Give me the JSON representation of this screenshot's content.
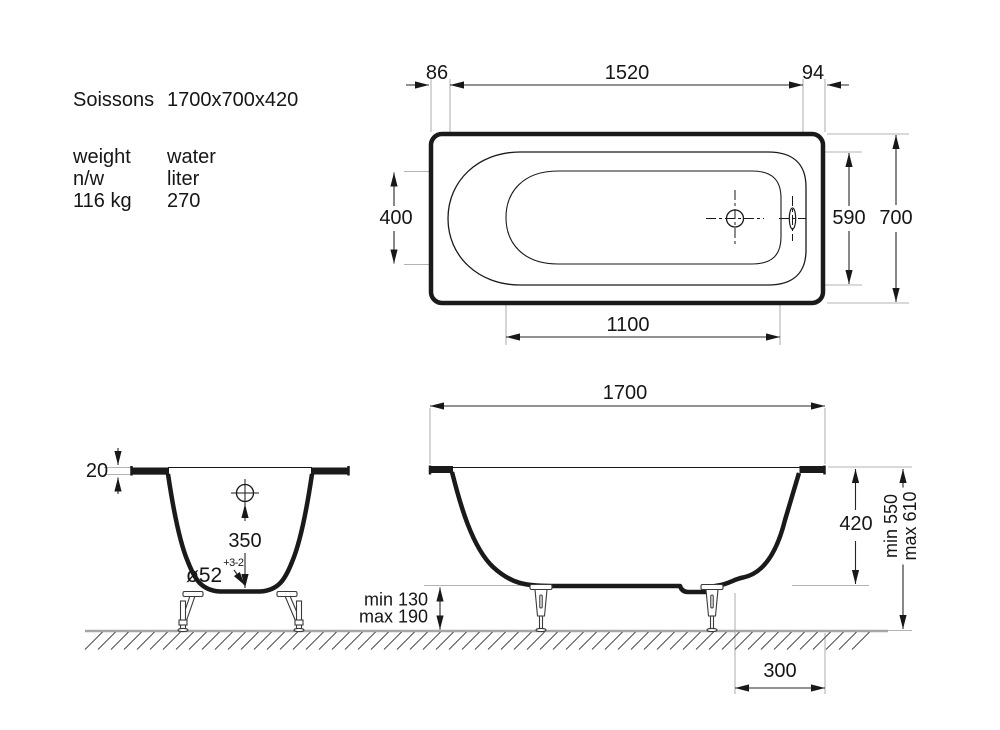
{
  "product": {
    "name": "Soissons",
    "dimensions": "1700x700x420"
  },
  "specs": {
    "weight_label": "weight",
    "weight_unit": "n/w",
    "weight_value": "116 kg",
    "water_label": "water",
    "water_unit": "liter",
    "water_value": "270"
  },
  "top_view": {
    "dim_edge_left": "86",
    "dim_rim_length": "1520",
    "dim_edge_right": "94",
    "dim_floor_width": "400",
    "dim_rim_width": "590",
    "dim_overall_width": "700",
    "dim_floor_length": "1100"
  },
  "side_view": {
    "dim_overall_length": "1700",
    "dim_tub_depth": "420",
    "dim_height_min": "min 550",
    "dim_height_max": "max 610",
    "dim_leg_clearance_min": "min 130",
    "dim_leg_clearance_max": "max 190",
    "dim_drain_to_end": "300"
  },
  "front_view": {
    "dim_rim_thickness": "20",
    "dim_overflow_to_bottom": "350",
    "dim_drain_diameter": "ø52",
    "dim_drain_tolerance": "+3-2"
  },
  "colors": {
    "line": "#1a1a1a",
    "dim_line": "#262626",
    "extension_line": "#b3b3b3",
    "ground": "#a6a6a6"
  }
}
